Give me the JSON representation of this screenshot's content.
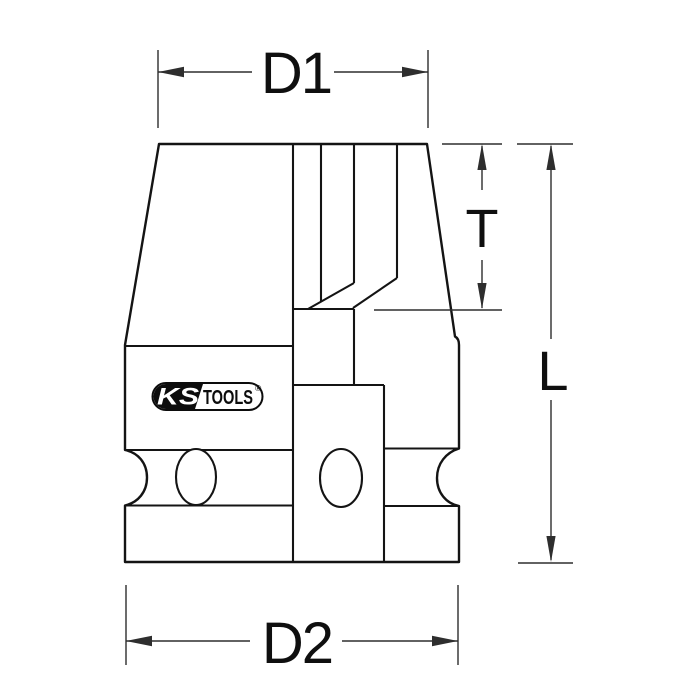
{
  "labels": {
    "d1": "D1",
    "d2": "D2",
    "t": "T",
    "l": "L"
  },
  "logo": {
    "ks": "KS",
    "tools": "TOOLS",
    "registered": "®"
  },
  "colors": {
    "bg": "#ffffff",
    "line": "#141414",
    "dim": "#2e2e2e",
    "label": "#0f0f0f",
    "logoInk": "#0c0c0c"
  }
}
